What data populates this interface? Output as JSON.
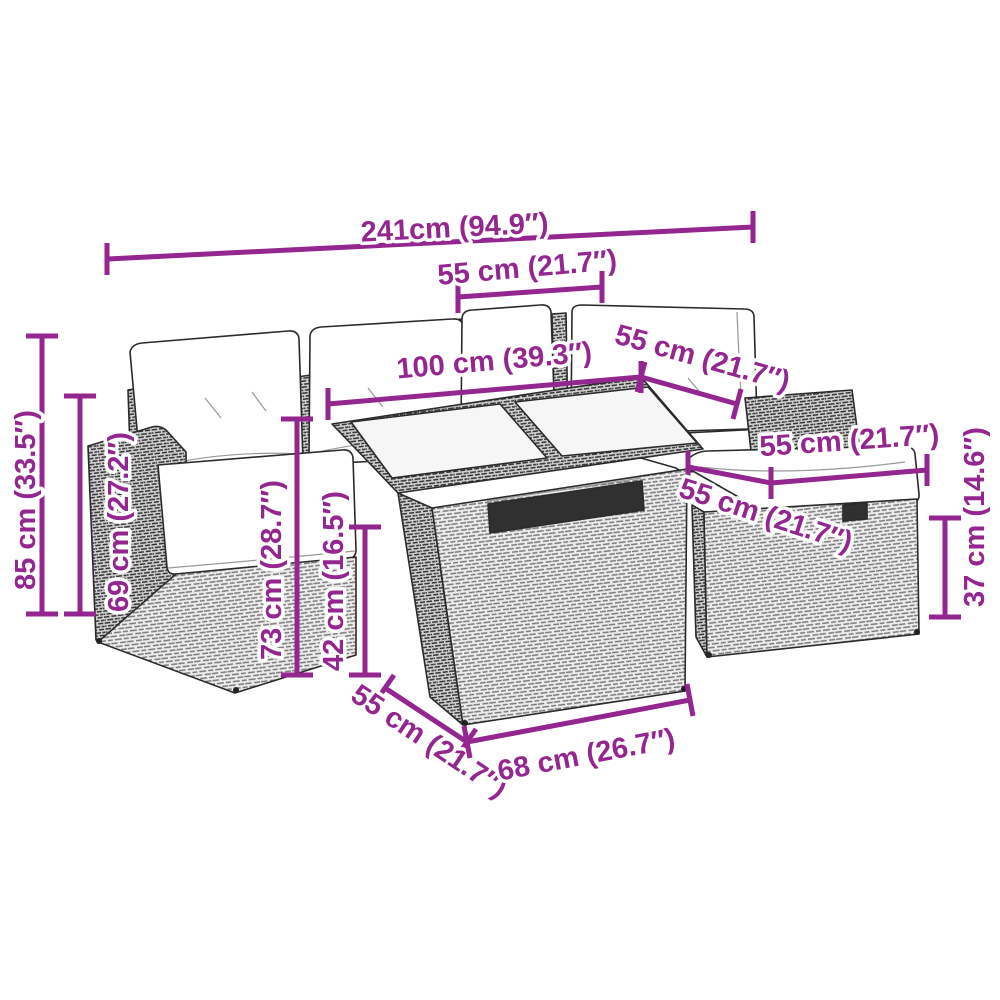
{
  "diagram": {
    "kind": "product-dimension-diagram",
    "subject": "rattan garden lounge set with corner sofa, glass-top table and storage ottomans"
  },
  "colors": {
    "accent": "#93268F",
    "outline": "#2b2b2b"
  },
  "annotations": [
    {
      "name": "set-total-width",
      "text": "241cm (94.9″)"
    },
    {
      "name": "back-section-width",
      "text": "55 cm (21.7″)"
    },
    {
      "name": "table-length",
      "text": "100 cm (39.3″)"
    },
    {
      "name": "rear-ottoman-width",
      "text": "55 cm (21.7″)"
    },
    {
      "name": "ottoman-cushion-width",
      "text": "55 cm (21.7″)"
    },
    {
      "name": "ottoman-depth",
      "text": "55 cm (21.7″)"
    },
    {
      "name": "table-depth",
      "text": "55 cm (21.7″)"
    },
    {
      "name": "table-front-width",
      "text": "68 cm (26.7″)"
    },
    {
      "name": "total-height",
      "text": "85 cm (33.5″)"
    },
    {
      "name": "backrest-height",
      "text": "69 cm (27.2″)"
    },
    {
      "name": "table-height",
      "text": "73 cm (28.7″)"
    },
    {
      "name": "shelf-height",
      "text": "42 cm (16.5″)"
    },
    {
      "name": "ottoman-height",
      "text": "37 cm (14.6″)"
    }
  ]
}
